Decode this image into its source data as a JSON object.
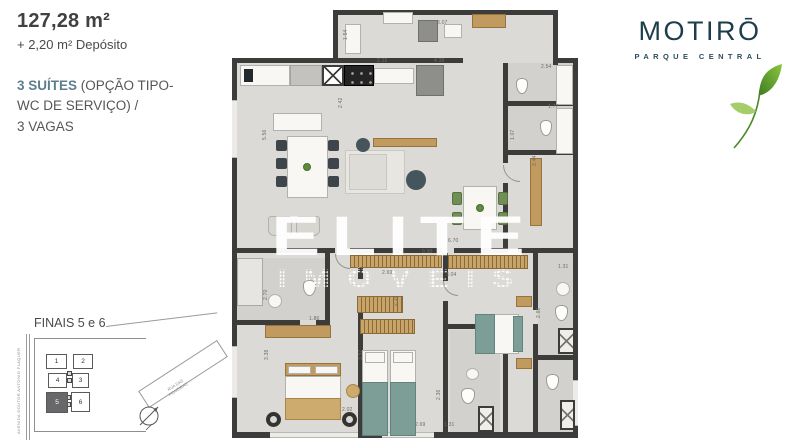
{
  "info": {
    "area": "127,28 m²",
    "deposito": "+ 2,20 m² Depósito",
    "suites_highlight": "3 SUÍTES",
    "suites_rest": " (OPÇÃO TIPO-",
    "suites_line2": "WC DE SERVIÇO) /",
    "suites_line3": "3 VAGAS"
  },
  "logo": {
    "brand": "MOTIRŌ",
    "tagline": "PARQUE CENTRAL",
    "brand_color": "#1d3d4b",
    "leaf_green_dark": "#3f7d23",
    "leaf_green_light": "#8cc63f",
    "leaf_icon": "leaf-icon"
  },
  "watermark": {
    "line1": "ELITE",
    "line2": "IMÓVEIS"
  },
  "plan": {
    "dims": [
      {
        "t": "3.07",
        "x": 207,
        "y": 12
      },
      {
        "t": "1.54",
        "x": 113,
        "y": 32,
        "v": 1
      },
      {
        "t": "2.15",
        "x": 147,
        "y": 50
      },
      {
        "t": "4.38",
        "x": 204,
        "y": 50
      },
      {
        "t": "2.54",
        "x": 311,
        "y": 56
      },
      {
        "t": "2.42",
        "x": 108,
        "y": 100,
        "v": 1
      },
      {
        "t": "1.77",
        "x": 318,
        "y": 96
      },
      {
        "t": "1.07",
        "x": 280,
        "y": 132,
        "v": 1
      },
      {
        "t": "3.44",
        "x": 302,
        "y": 158,
        "v": 1
      },
      {
        "t": "5.56",
        "x": 32,
        "y": 132,
        "v": 1
      },
      {
        "t": "6.70",
        "x": 218,
        "y": 230
      },
      {
        "t": "0.90",
        "x": 192,
        "y": 241
      },
      {
        "t": "2.69",
        "x": 152,
        "y": 262
      },
      {
        "t": "3.04",
        "x": 216,
        "y": 264
      },
      {
        "t": "2.18",
        "x": 163,
        "y": 298,
        "v": 1
      },
      {
        "t": "1.86",
        "x": 79,
        "y": 308
      },
      {
        "t": "2.70",
        "x": 33,
        "y": 292,
        "v": 1
      },
      {
        "t": "3.38",
        "x": 34,
        "y": 352,
        "v": 1
      },
      {
        "t": "3.57",
        "x": 128,
        "y": 352,
        "v": 1
      },
      {
        "t": "1.31",
        "x": 328,
        "y": 256
      },
      {
        "t": "2.60",
        "x": 306,
        "y": 310,
        "v": 1
      },
      {
        "t": "2.36",
        "x": 206,
        "y": 392,
        "v": 1
      },
      {
        "t": "2.02",
        "x": 112,
        "y": 399
      },
      {
        "t": "2.69",
        "x": 185,
        "y": 414
      },
      {
        "t": "1.31",
        "x": 214,
        "y": 414
      }
    ]
  },
  "keyplan": {
    "title": "FINAIS 5 e 6",
    "street_left": "AVENIDA DOUTOR ANTONIO FLAQUER",
    "street_diag_line1": "RUA DAS",
    "street_diag_line2": "FIGUEIRAS",
    "highlighted_unit": "5",
    "units": [
      {
        "n": "1",
        "x": 38,
        "y": 38,
        "w": 21,
        "h": 15
      },
      {
        "n": "2",
        "x": 65,
        "y": 38,
        "w": 20,
        "h": 15
      },
      {
        "n": "4",
        "x": 40,
        "y": 57,
        "w": 19,
        "h": 15
      },
      {
        "n": "3",
        "x": 64,
        "y": 57,
        "w": 17,
        "h": 15
      },
      {
        "n": "5",
        "x": 38,
        "y": 76,
        "w": 22,
        "h": 21,
        "hl": true
      },
      {
        "n": "6",
        "x": 63,
        "y": 76,
        "w": 19,
        "h": 20
      }
    ]
  }
}
